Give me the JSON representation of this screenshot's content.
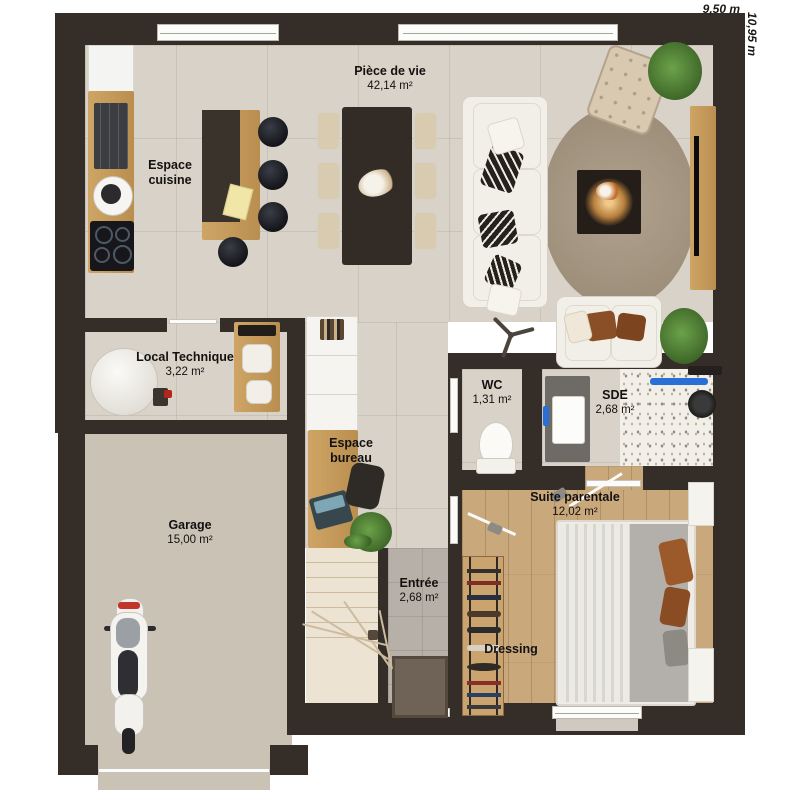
{
  "plan": {
    "title": "floor-plan",
    "dimensions": {
      "width": "9,50 m",
      "height": "10,95 m"
    },
    "rooms": {
      "piece_de_vie": {
        "name": "Pièce de vie",
        "area": "42,14 m²"
      },
      "espace_cuisine": {
        "name": "Espace cuisine"
      },
      "local_technique": {
        "name": "Local Technique",
        "area": "3,22 m²"
      },
      "wc": {
        "name": "WC",
        "area": "1,31 m²"
      },
      "sde": {
        "name": "SDE",
        "area": "2,68 m²"
      },
      "suite_parentale": {
        "name": "Suite parentale",
        "area": "12,02 m²"
      },
      "espace_bureau": {
        "name": "Espace bureau"
      },
      "garage": {
        "name": "Garage",
        "area": "15,00 m²"
      },
      "entree": {
        "name": "Entrée",
        "area": "2,68 m²"
      },
      "dressing": {
        "name": "Dressing"
      }
    },
    "colors": {
      "wall": "#352d27",
      "tile_floor": "#d9d2c8",
      "wood_floor": "#c9a87c",
      "garage_floor": "#c9c2b5",
      "entry_floor": "#b6b0a8",
      "accent_blue": "#2a6fd4",
      "accent_orange": "#9c5a2a",
      "label_text": "#131110"
    }
  }
}
